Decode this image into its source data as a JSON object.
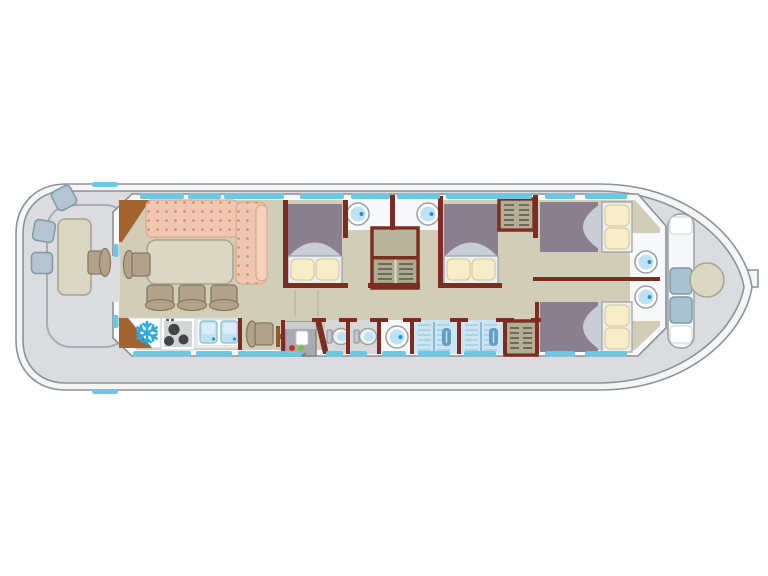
{
  "meta": {
    "app": "boat-floor-plan",
    "description": "Top-down interior deck plan of a canal houseboat with aft deck, saloon, galley, corridor, four double cabins, two toilets, two showers and a bow seating deck",
    "canvas": {
      "width": 768,
      "height": 576
    }
  },
  "colors": {
    "bg": "#ffffff",
    "hull": "#f4f5f7",
    "hull_stroke": "#8f9296",
    "deck": "#dadce0",
    "coaming": "#a8acb0",
    "floor": "#d1cdb6",
    "wall": "#7c2c20",
    "window": "#6cc7e4",
    "wood": "#a3632e",
    "wood_dark": "#8a5a2e",
    "sofa": "#f0c7b1",
    "sofa_dot": "#cf8a6d",
    "sofa_bolster": "#f4d2bd",
    "table": "#dad8c2",
    "table_stroke": "#a6a48e",
    "chair": "#b3a28a",
    "chair_stroke": "#857a64",
    "stool": "#b4c5d1",
    "stool_stroke": "#8098a6",
    "cushion": "#a9c2d2",
    "bed": "#8a7f8e",
    "bed_fold": "#c9cdd5",
    "mattress": "#eceef2",
    "pillow": "#f7eec9",
    "pillow_stroke": "#d8cda0",
    "wardrobe": "#b3ad92",
    "shelf": "#55544a",
    "unit_top": "#b8b39b",
    "basin_ring": "#ffffff",
    "basin_stroke": "#9aa0a6",
    "basin": "#bde2f3",
    "basin_dot": "#2394d0",
    "bowl": "#f0f1f2",
    "toilet_floor": "#d7d8da",
    "bath_white": "#f7f8f9",
    "shower": "#cde4f2",
    "shower_line": "#a4cbe2",
    "fixture": "#5f9ec6",
    "appliance": "#a7aaae",
    "appliance_top": "#c9cbcd",
    "led_red": "#d62a1d",
    "led_green": "#77c043",
    "snow": "#2aabe2",
    "stove": "#d4d5d6",
    "burner": "#434546",
    "counter": "#fdfdfe",
    "counter_stroke": "#d9dadb"
  },
  "plan": {
    "areas": [
      "aft-deck",
      "saloon",
      "galley",
      "corridor",
      "cabin-aft",
      "washbasin-alcove-1",
      "washbasin-alcove-2",
      "cabin-mid",
      "toilet-1",
      "toilet-2",
      "washbasin-room",
      "shower-1",
      "shower-2",
      "wardrobe-aft",
      "cabin-bow-port",
      "cabin-bow-starboard",
      "bow-vestibule",
      "bow-deck"
    ],
    "inventory": {
      "aft_deck": {
        "stools": 3,
        "table": 1,
        "helm_seat": 1
      },
      "saloon": {
        "sofa": "L-shaped",
        "dining_table": 1,
        "chairs": 4
      },
      "galley": {
        "fridge_freezer": 1,
        "hob_burners": 3,
        "sink_bowls": 2,
        "nav_seat": 1,
        "washing_machine": 1
      },
      "cabins": 4,
      "double_beds": 4,
      "round_washbasins": 5,
      "toilets": 2,
      "showers": 2,
      "wardrobes": 3,
      "bow_deck": {
        "bench_cushions": 2,
        "round_table": 1
      }
    }
  }
}
